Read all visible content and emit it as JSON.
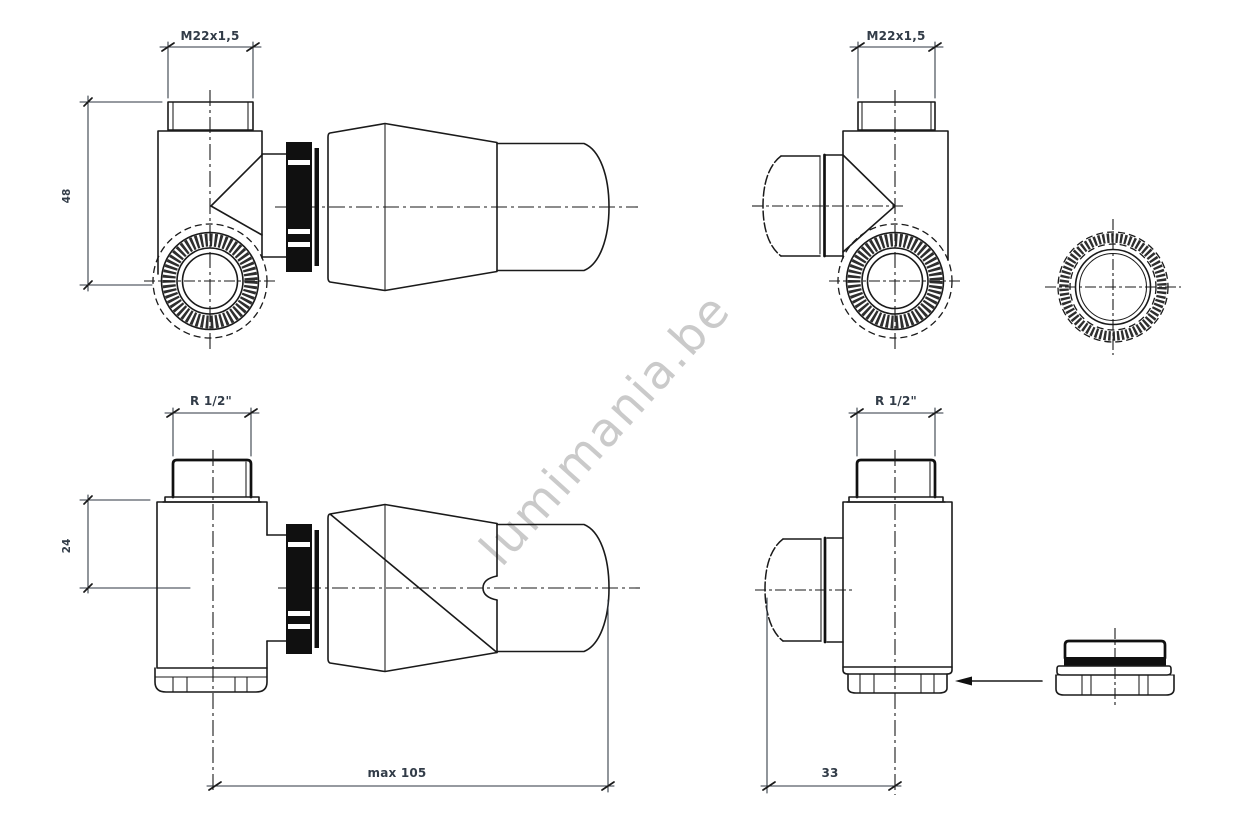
{
  "drawing": {
    "type": "technical-drawing",
    "subject": "thermostatic radiator valve - four orthographic views with accessories",
    "watermark": "lumimania.be",
    "colors": {
      "line": "#1a1a1a",
      "dim_text": "#323c48",
      "watermark": "#c8c8c8",
      "ring_fill": "#101010",
      "background": "#ffffff"
    },
    "views": {
      "top_left": {
        "thread_label": "M22x1,5",
        "height_dim": "48"
      },
      "top_right": {
        "thread_label": "M22x1,5"
      },
      "bottom_left": {
        "thread_label": "R 1/2\"",
        "height_dim": "24",
        "length_dim": "max 105"
      },
      "bottom_right": {
        "thread_label": "R 1/2\"",
        "offset_dim": "33"
      }
    }
  }
}
